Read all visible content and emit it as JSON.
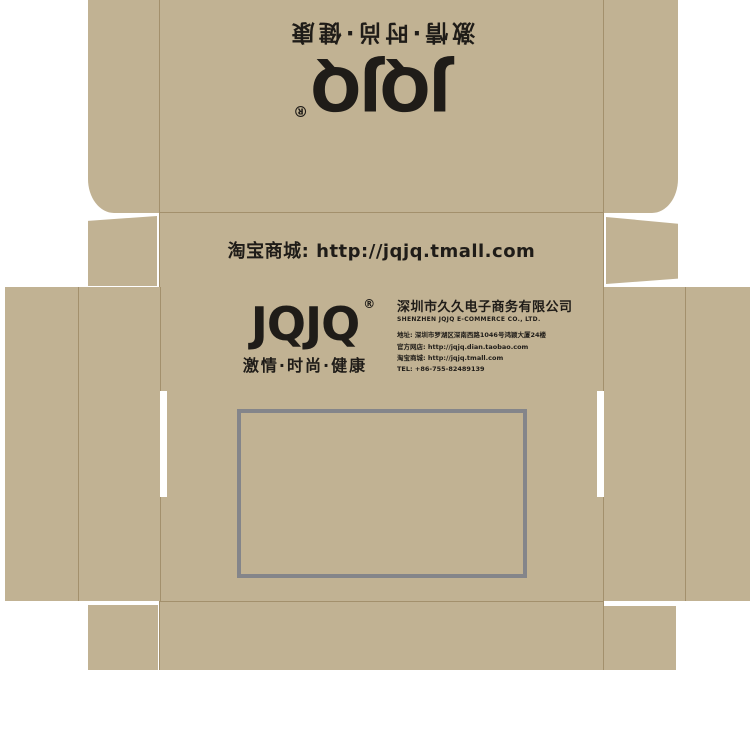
{
  "colors": {
    "cardboard": "#c1b293",
    "ink": "#1f1c18",
    "window_border": "#84858a",
    "fold_line": "#a3906c",
    "background": "#ffffff"
  },
  "brand": {
    "logo": "JQJQ",
    "registered": "®",
    "tagline": "激情·时尚·健康"
  },
  "front_band": {
    "label": "淘宝商城: http://jqjq.tmall.com"
  },
  "company": {
    "name_cn": "深圳市久久电子商务有限公司",
    "name_en": "SHENZHEN JQJQ E-COMMERCE CO., LTD.",
    "address": "地址: 深圳市罗湖区深南西路1046号鸿颖大厦24楼",
    "official_store": "官方网店: http://jqjq.dian.taobao.com",
    "tmall_store": "淘宝商城: http://jqjq.tmall.com",
    "tel": "TEL: +86-755-82489139"
  }
}
